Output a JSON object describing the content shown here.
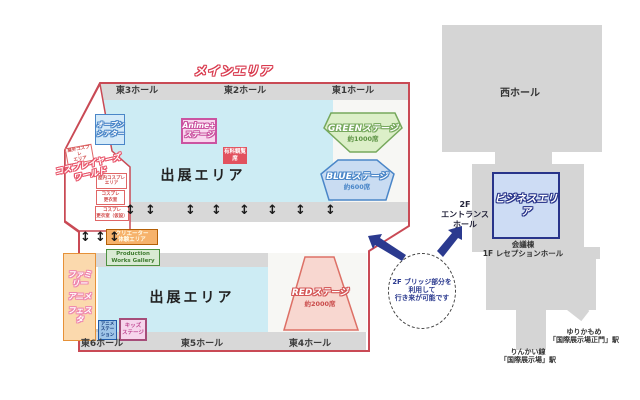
{
  "icons": {
    "two_way_arrow": "↕"
  },
  "map": {
    "main_label": "メインエリア",
    "halls_top": [
      "東3ホール",
      "東2ホール",
      "東1ホール"
    ],
    "halls_bottom": [
      "東6ホール",
      "東5ホール",
      "東4ホール"
    ],
    "exhibit_upper": "出展エリア",
    "exhibit_lower": "出展エリア",
    "open_theater": [
      "オープン",
      "シアター"
    ],
    "anime_stage": [
      "Anime+",
      "ステージ"
    ],
    "paid_seat_badge": "有料観覧席",
    "green_stage": {
      "name": "GREENステージ",
      "seats": "約1000席"
    },
    "blue_stage": {
      "name": "BLUEステージ",
      "seats": "約600席"
    },
    "red_stage": {
      "name": "REDステージ",
      "seats": "約2000席"
    },
    "cosplay": {
      "title": [
        "コスプレイヤーズ",
        "ワールド"
      ],
      "outdoor": [
        "屋外コスプレ",
        "エリア"
      ],
      "indoor": [
        "屋内コスプレ",
        "エリア"
      ],
      "dress1": [
        "コスプレ",
        "更衣室"
      ],
      "dress2": [
        "コスプレ",
        "更衣室（仮設）"
      ]
    },
    "family": [
      "ファミリー",
      "アニメ",
      "フェスタ"
    ],
    "anime_station": [
      "アニメ",
      "ステーション"
    ],
    "kids_stage": [
      "キッズ",
      "ステージ"
    ],
    "creator": [
      "クリエーター",
      "体験エリア"
    ],
    "production": [
      "Production",
      "Works Gallery"
    ]
  },
  "right": {
    "west_hall": "西ホール",
    "business": "ビジネスエリア",
    "entrance": [
      "2F",
      "エントランス",
      "ホール"
    ],
    "reception": [
      "会議棟",
      "1F レセプションホール"
    ],
    "yurikamome": [
      "ゆりかもめ",
      "「国際展示場正門」駅"
    ],
    "rinkai": [
      "りんかい線",
      "「国際展示場」駅"
    ],
    "bridge_note": [
      "2F ブリッジ部分を",
      "利用して",
      "行き来が可能です"
    ]
  },
  "colors": {
    "outline_red": "#c94a55",
    "hall_gray": "#d8d8d8",
    "exhibit_cyan": "#cdecf4",
    "stage_green": "#76a85c",
    "stage_blue": "#4a86c8",
    "stage_red": "#e06666",
    "stage_pink": "#cb54a1",
    "navy": "#2b3a8f",
    "orange": "#e69138"
  }
}
